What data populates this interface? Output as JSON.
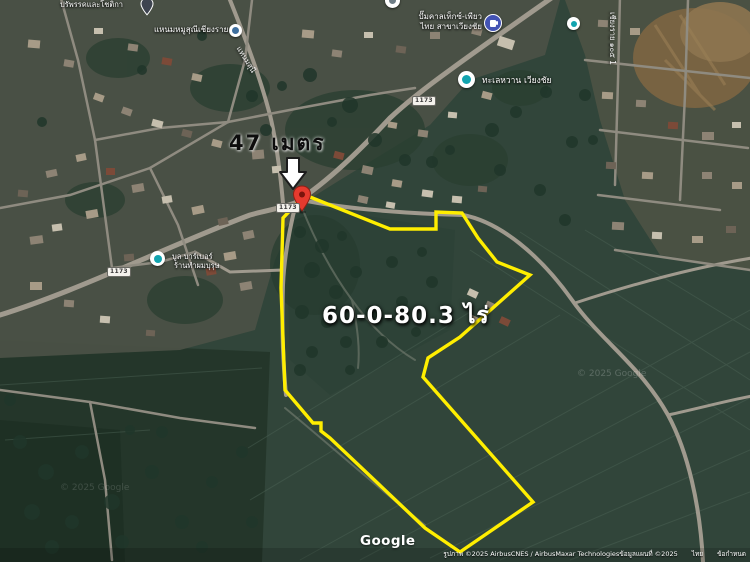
{
  "annotations": {
    "frontage": "47 เมตร",
    "area": "60-0-80.3 ไร่"
  },
  "pois": {
    "resort": {
      "label": "ปรัพรรคและโชติกา"
    },
    "nham_shop": {
      "label": "แหนมหมูสุณีเชียงราย"
    },
    "gas_station": {
      "line1": "ปั๊มคาลเท็กซ์-เพียว",
      "line2": "ไทย สาขาเวียงชัย"
    },
    "talay": {
      "label": "ทะเลหวาน เวียงชัย"
    },
    "barber": {
      "line1": "บูล บาร์เบอร์",
      "line2": "ร้านทำผมบุรุษ"
    }
  },
  "roads": {
    "shield": "1173",
    "nham_road": "แหนมสุนี",
    "vertical_road": "เชียงราย ๑๐๕ 1"
  },
  "watermark": "© 2025 Google",
  "footer": {
    "logo": "Google",
    "attribution": "รูปภาพ ©2025 AirbusCNES / AirbusMaxar Technologiesข้อมูลแผนที่ ©2025",
    "country": "ไทย",
    "terms": "ข้อกำหนด"
  },
  "colors": {
    "plot_outline": "#ffee00",
    "pin_red": "#e63a2e",
    "poi_blue": "#4353b4",
    "poi_teal": "#12a4af",
    "road": "#a09a8e"
  }
}
